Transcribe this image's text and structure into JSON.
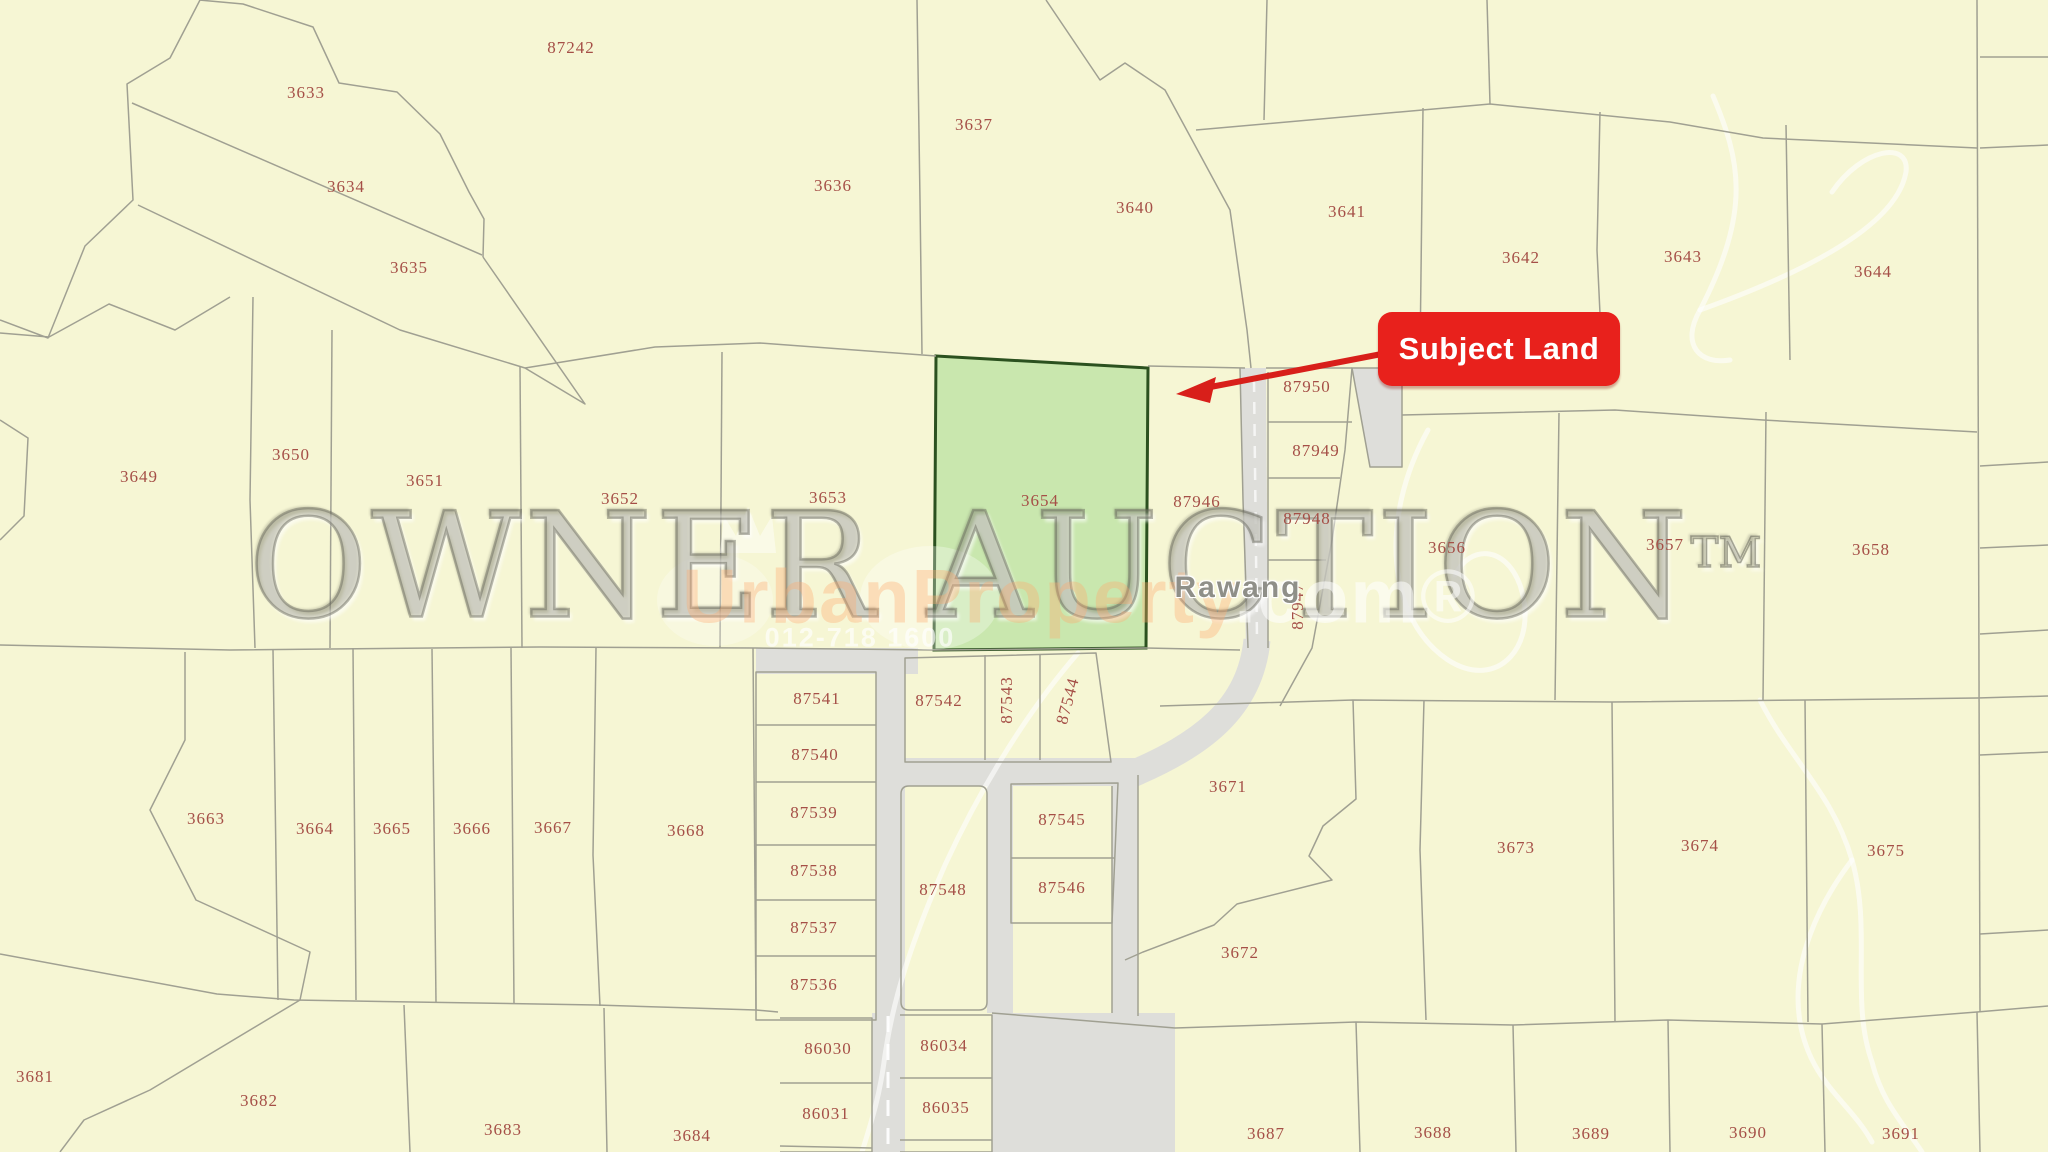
{
  "map": {
    "subject_badge": {
      "label": "Subject Land"
    },
    "subject_lot": "3654",
    "place_label": "Rawang",
    "watermarks": {
      "brand": "OWNER AUCTION",
      "brand_tm": "TM",
      "property_name": "UrbanProperty",
      "property_suffix": ".com®",
      "phone": "012-718 1600",
      "crown_icon": "crown-icon"
    },
    "colors": {
      "parcel_fill": "#f6f6d4",
      "road_fill": "#dededa",
      "boundary_line": "#a0a092",
      "subject_fill": "#c9e7ae",
      "subject_border": "#2b511f",
      "lot_label": "#a54f47",
      "badge_red": "#e8211c",
      "arrow_red": "#d81f1a"
    },
    "lots": [
      {
        "n": "3633",
        "x": 306,
        "y": 93
      },
      {
        "n": "87242",
        "x": 571,
        "y": 48
      },
      {
        "n": "3634",
        "x": 346,
        "y": 187
      },
      {
        "n": "3635",
        "x": 409,
        "y": 268
      },
      {
        "n": "3636",
        "x": 833,
        "y": 186
      },
      {
        "n": "3637",
        "x": 974,
        "y": 125
      },
      {
        "n": "3640",
        "x": 1135,
        "y": 208
      },
      {
        "n": "3641",
        "x": 1347,
        "y": 212
      },
      {
        "n": "3642",
        "x": 1521,
        "y": 258
      },
      {
        "n": "3643",
        "x": 1683,
        "y": 257
      },
      {
        "n": "3644",
        "x": 1873,
        "y": 272
      },
      {
        "n": "3649",
        "x": 139,
        "y": 477
      },
      {
        "n": "3650",
        "x": 291,
        "y": 455
      },
      {
        "n": "3651",
        "x": 425,
        "y": 481
      },
      {
        "n": "3652",
        "x": 620,
        "y": 499
      },
      {
        "n": "3653",
        "x": 828,
        "y": 498
      },
      {
        "n": "3654",
        "x": 1040,
        "y": 501
      },
      {
        "n": "87946",
        "x": 1197,
        "y": 502
      },
      {
        "n": "87950",
        "x": 1307,
        "y": 387
      },
      {
        "n": "87949",
        "x": 1316,
        "y": 451
      },
      {
        "n": "87948",
        "x": 1307,
        "y": 519
      },
      {
        "n": "87947",
        "x": 1298,
        "y": 606,
        "angle": -90
      },
      {
        "n": "3656",
        "x": 1447,
        "y": 548
      },
      {
        "n": "3657",
        "x": 1665,
        "y": 545
      },
      {
        "n": "3658",
        "x": 1871,
        "y": 550
      },
      {
        "n": "87541",
        "x": 817,
        "y": 699
      },
      {
        "n": "87540",
        "x": 815,
        "y": 755
      },
      {
        "n": "87539",
        "x": 814,
        "y": 813
      },
      {
        "n": "87538",
        "x": 814,
        "y": 871
      },
      {
        "n": "87537",
        "x": 814,
        "y": 928
      },
      {
        "n": "87536",
        "x": 814,
        "y": 985
      },
      {
        "n": "87542",
        "x": 939,
        "y": 701
      },
      {
        "n": "87543",
        "x": 1007,
        "y": 700,
        "angle": -90
      },
      {
        "n": "87544",
        "x": 1068,
        "y": 701,
        "angle": -75
      },
      {
        "n": "87545",
        "x": 1062,
        "y": 820
      },
      {
        "n": "87546",
        "x": 1062,
        "y": 888
      },
      {
        "n": "87548",
        "x": 943,
        "y": 890
      },
      {
        "n": "3663",
        "x": 206,
        "y": 819
      },
      {
        "n": "3664",
        "x": 315,
        "y": 829
      },
      {
        "n": "3665",
        "x": 392,
        "y": 829
      },
      {
        "n": "3666",
        "x": 472,
        "y": 829
      },
      {
        "n": "3667",
        "x": 553,
        "y": 828
      },
      {
        "n": "3668",
        "x": 686,
        "y": 831
      },
      {
        "n": "3671",
        "x": 1228,
        "y": 787
      },
      {
        "n": "3672",
        "x": 1240,
        "y": 953
      },
      {
        "n": "3673",
        "x": 1516,
        "y": 848
      },
      {
        "n": "3674",
        "x": 1700,
        "y": 846
      },
      {
        "n": "3675",
        "x": 1886,
        "y": 851
      },
      {
        "n": "3681",
        "x": 35,
        "y": 1077
      },
      {
        "n": "3682",
        "x": 259,
        "y": 1101
      },
      {
        "n": "3683",
        "x": 503,
        "y": 1130
      },
      {
        "n": "3684",
        "x": 692,
        "y": 1136
      },
      {
        "n": "86030",
        "x": 828,
        "y": 1049
      },
      {
        "n": "86031",
        "x": 826,
        "y": 1114
      },
      {
        "n": "86034",
        "x": 944,
        "y": 1046
      },
      {
        "n": "86035",
        "x": 946,
        "y": 1108
      },
      {
        "n": "3687",
        "x": 1266,
        "y": 1134
      },
      {
        "n": "3688",
        "x": 1433,
        "y": 1133
      },
      {
        "n": "3689",
        "x": 1591,
        "y": 1134
      },
      {
        "n": "3690",
        "x": 1748,
        "y": 1133
      },
      {
        "n": "3691",
        "x": 1901,
        "y": 1134
      }
    ]
  }
}
